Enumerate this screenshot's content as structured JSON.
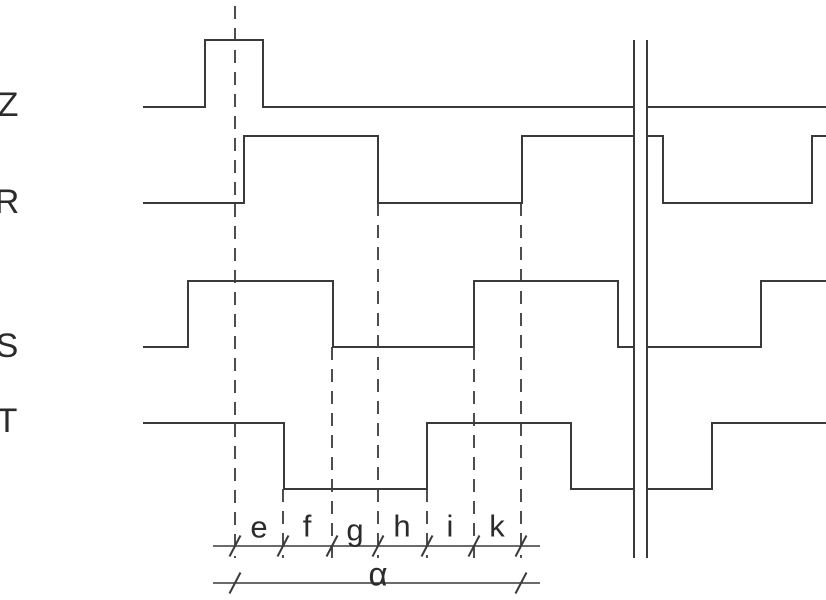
{
  "diagram": {
    "canvas": {
      "width": 826,
      "height": 600,
      "background": "#ffffff",
      "line_color": "#3a3a3a",
      "text_color": "#2b2b2b"
    },
    "signals": [
      {
        "name": "Z",
        "label": "Z",
        "label_pos": {
          "x": 8,
          "y": 105
        },
        "levels": {
          "high_y": 40,
          "low_y": 107
        },
        "segments": [
          [
            [
              143,
              107
            ],
            [
              205,
              107
            ],
            [
              205,
              40
            ],
            [
              263,
              40
            ],
            [
              263,
              107
            ],
            [
              633,
              107
            ]
          ],
          [
            [
              648,
              107
            ],
            [
              826,
              107
            ]
          ]
        ]
      },
      {
        "name": "R",
        "label": "R",
        "label_pos": {
          "x": 7,
          "y": 202
        },
        "levels": {
          "high_y": 136,
          "low_y": 203
        },
        "segments": [
          [
            [
              143,
              203
            ],
            [
              244,
              203
            ],
            [
              244,
              136
            ],
            [
              378,
              136
            ],
            [
              378,
              203
            ],
            [
              522,
              203
            ],
            [
              522,
              136
            ],
            [
              633,
              136
            ]
          ],
          [
            [
              648,
              136
            ],
            [
              663,
              136
            ],
            [
              663,
              203
            ],
            [
              812,
              203
            ],
            [
              812,
              136
            ],
            [
              826,
              136
            ]
          ]
        ]
      },
      {
        "name": "S",
        "label": "S",
        "label_pos": {
          "x": 7,
          "y": 346
        },
        "levels": {
          "high_y": 281,
          "low_y": 347
        },
        "segments": [
          [
            [
              143,
              347
            ],
            [
              188,
              347
            ],
            [
              188,
              281
            ],
            [
              333,
              281
            ],
            [
              333,
              347
            ],
            [
              474,
              347
            ],
            [
              474,
              281
            ],
            [
              618,
              281
            ],
            [
              618,
              347
            ],
            [
              633,
              347
            ]
          ],
          [
            [
              648,
              347
            ],
            [
              761,
              347
            ],
            [
              761,
              281
            ],
            [
              826,
              281
            ]
          ]
        ]
      },
      {
        "name": "T",
        "label": "T",
        "label_pos": {
          "x": 7,
          "y": 421
        },
        "levels": {
          "high_y": 423,
          "low_y": 489
        },
        "segments": [
          [
            [
              143,
              423
            ],
            [
              284,
              423
            ],
            [
              284,
              489
            ],
            [
              427,
              489
            ],
            [
              427,
              423
            ],
            [
              571,
              423
            ],
            [
              571,
              489
            ],
            [
              633,
              489
            ]
          ],
          [
            [
              648,
              489
            ],
            [
              712,
              489
            ],
            [
              712,
              423
            ],
            [
              826,
              423
            ]
          ]
        ]
      }
    ],
    "event_markers": {
      "dash_pattern": "13 9",
      "lines": [
        {
          "x": 235,
          "y1": 6,
          "y2": 558
        },
        {
          "x": 283,
          "y1": 489,
          "y2": 558
        },
        {
          "x": 332,
          "y1": 347,
          "y2": 558
        },
        {
          "x": 378,
          "y1": 203,
          "y2": 558
        },
        {
          "x": 427,
          "y1": 489,
          "y2": 558
        },
        {
          "x": 474,
          "y1": 347,
          "y2": 558
        },
        {
          "x": 521,
          "y1": 203,
          "y2": 558
        }
      ]
    },
    "break_mark": {
      "x1": 634,
      "x2": 647,
      "y_top": 40,
      "y_bottom": 558
    },
    "dimensions": {
      "intervals_line": {
        "y": 546,
        "x_start": 213,
        "x_end": 540,
        "ticks": [
          235,
          283,
          332,
          378,
          427,
          474,
          521
        ]
      },
      "intervals": [
        {
          "label": "e",
          "x": 259,
          "y": 527
        },
        {
          "label": "f",
          "x": 307,
          "y": 526
        },
        {
          "label": "g",
          "x": 355,
          "y": 530
        },
        {
          "label": "h",
          "x": 402,
          "y": 526
        },
        {
          "label": "i",
          "x": 450,
          "y": 526
        },
        {
          "label": "k",
          "x": 497,
          "y": 526
        }
      ],
      "total_line": {
        "y": 583,
        "x_start": 213,
        "x_end": 540,
        "ticks": [
          235,
          521
        ]
      },
      "total": {
        "label": "α",
        "x": 378,
        "y": 574
      }
    }
  }
}
